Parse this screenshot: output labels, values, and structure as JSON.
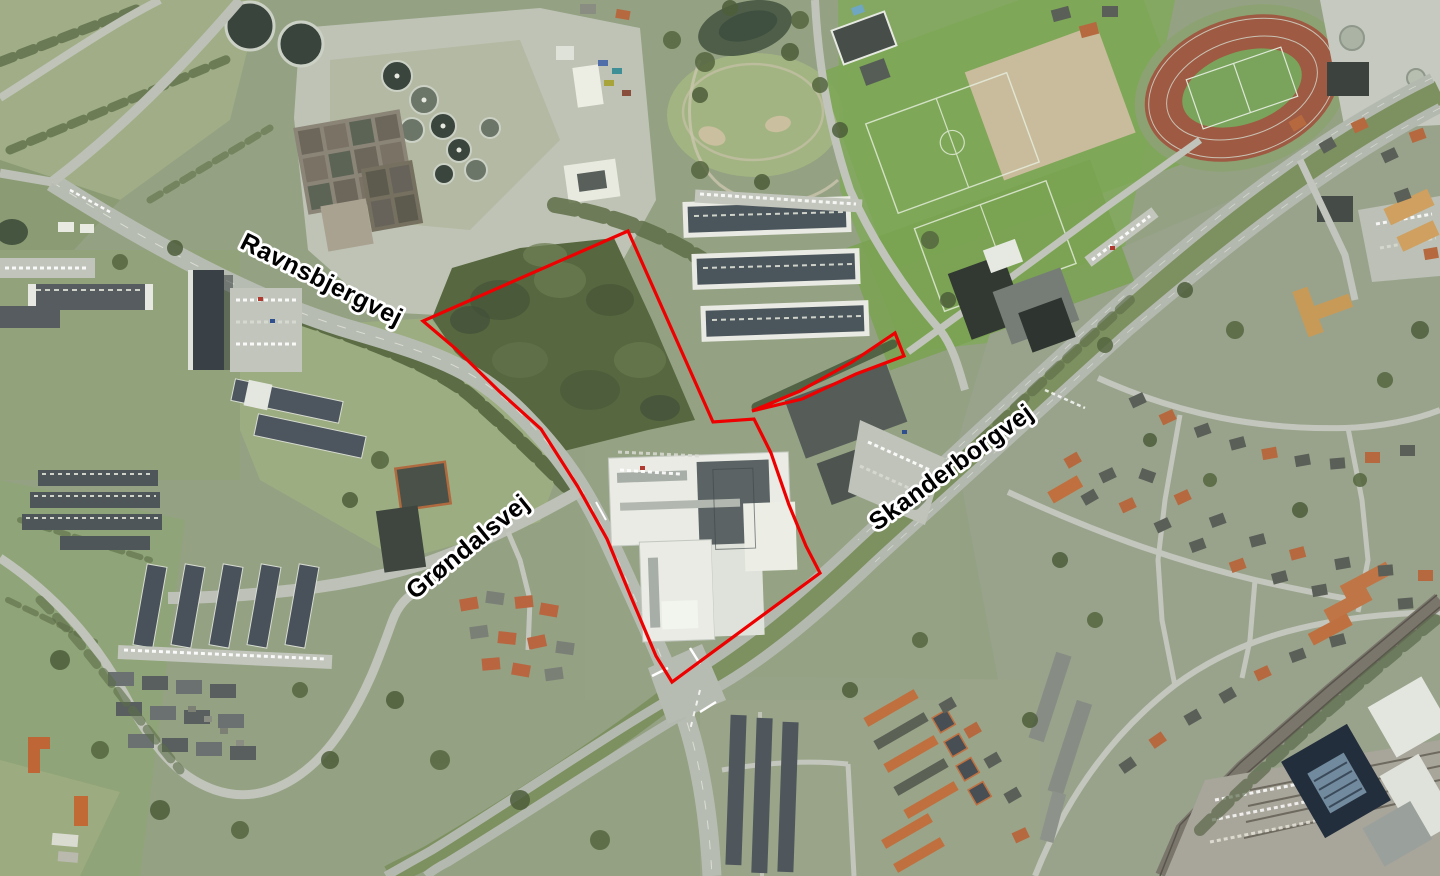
{
  "map": {
    "labels": [
      {
        "id": "ravnsbjergvej",
        "text": "Ravnsbjergvej",
        "transform": "translate(318 287) rotate(26.5)"
      },
      {
        "id": "grondalsvej",
        "text": "Grøndalsvej",
        "transform": "translate(473 553) rotate(-39)"
      },
      {
        "id": "skanderborgvej",
        "text": "Skanderborgvej",
        "transform": "translate(956 474) rotate(-36)"
      }
    ],
    "overlay": {
      "stroke": "#ee0000",
      "stroke_width": "3.2",
      "polygons": [
        {
          "id": "site-boundary-main",
          "points": "628,231 713,422 754,419 771,453 789,505 806,546 820,573 672,682 656,656 631,597 607,539 578,487 541,429 500,392 456,349 423,321"
        },
        {
          "id": "site-boundary-strip",
          "points": "752,411 800,391 852,362 895,333 904,356 856,374 802,399"
        }
      ]
    }
  }
}
